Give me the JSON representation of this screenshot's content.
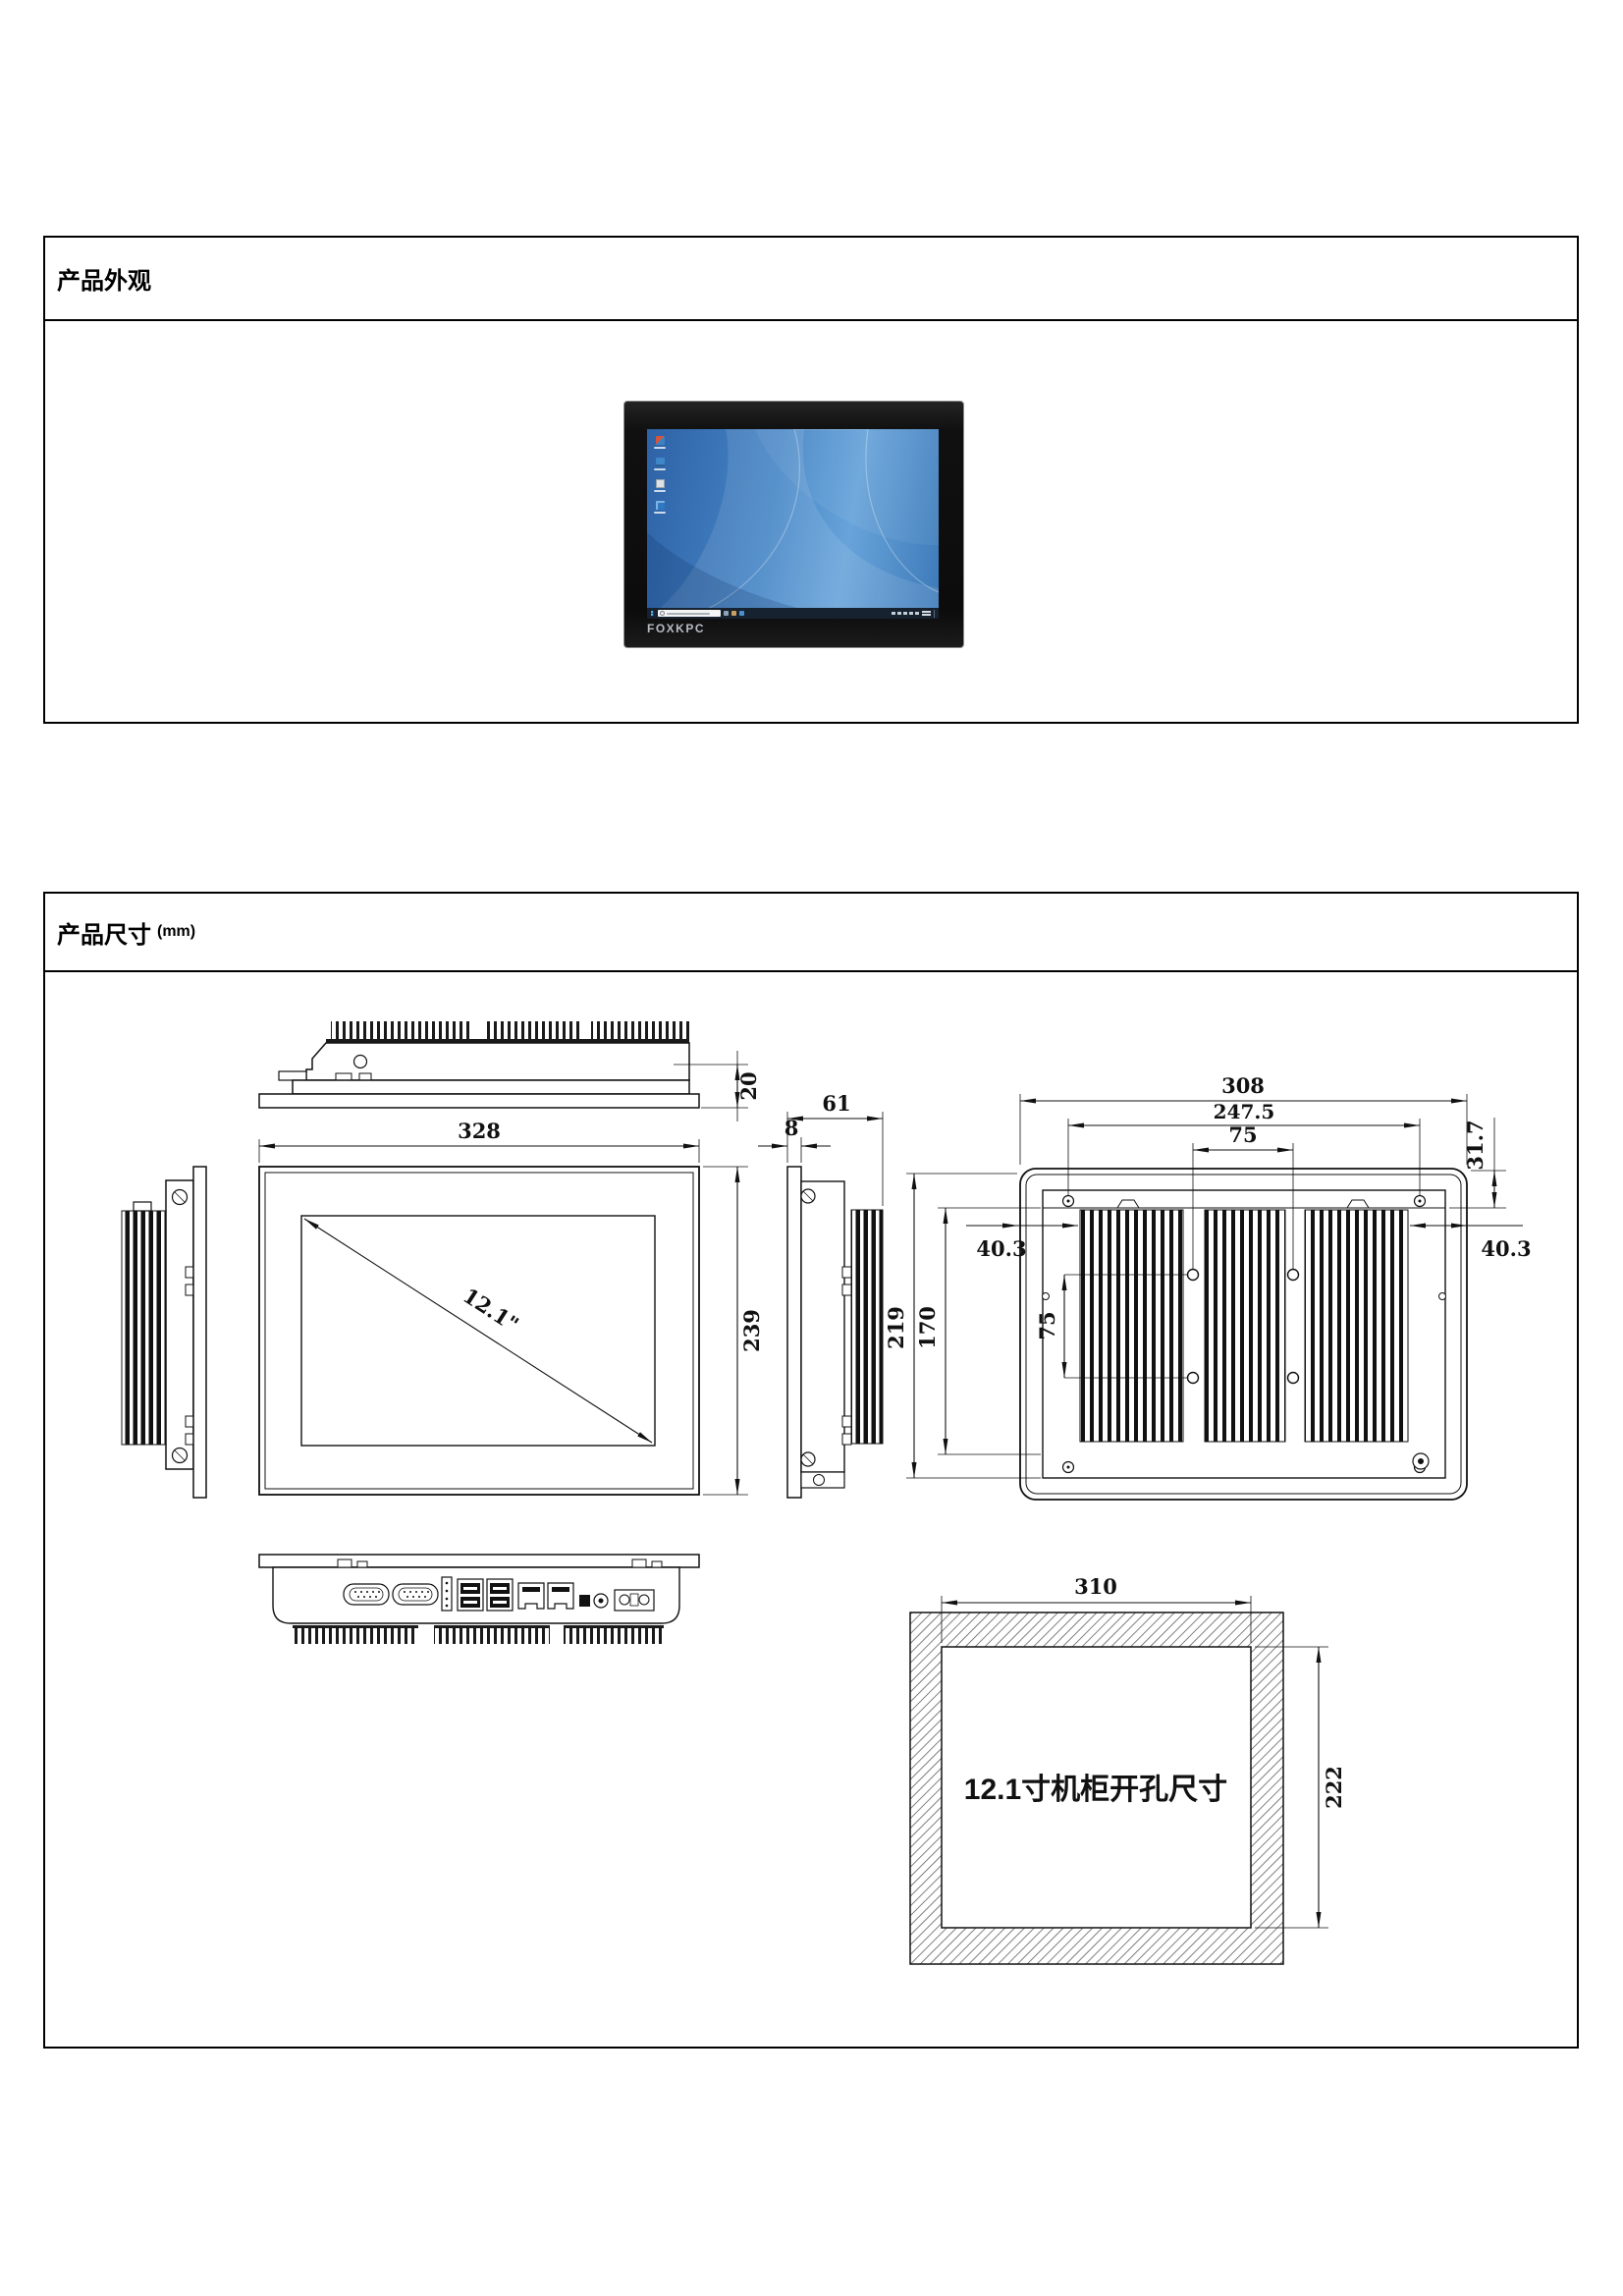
{
  "sections": {
    "appearance": {
      "title": "产品外观"
    },
    "dimensions": {
      "title": "产品尺寸",
      "unit": "(mm)"
    }
  },
  "monitor": {
    "brand": "FOXKPC"
  },
  "dims": {
    "top_view": {
      "thickness": "20"
    },
    "front_view": {
      "width": "328",
      "height": "239",
      "diagonal": "12.1\""
    },
    "side_view": {
      "depth": "61",
      "panel": "8"
    },
    "rear_view": {
      "width": "308",
      "mount_span": "247.5",
      "vesa_h": "75",
      "vesa_v": "75",
      "top_offset": "31.7",
      "left_offset": "40.3",
      "right_offset": "40.3",
      "height": "219",
      "body_height": "170"
    },
    "cutout": {
      "width": "310",
      "height": "222",
      "label": "12.1寸机柜开孔尺寸"
    }
  }
}
